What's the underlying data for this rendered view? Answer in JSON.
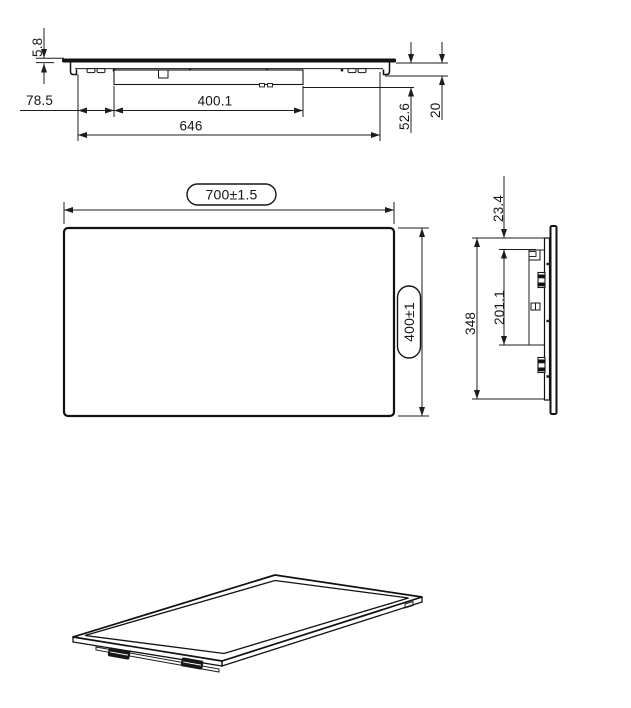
{
  "page": {
    "background": "#ffffff",
    "line_color": "#161616",
    "description": "Three-view dimensioned technical drawing of a flat panel with mounting rail, plus isometric view"
  },
  "views": {
    "top": {
      "dim_thickness": "5.8",
      "dim_bracket_offset": "78.5",
      "dim_rail_width": "400.1",
      "dim_mount_width": "646",
      "dim_total_depth": "52.6",
      "dim_edge_depth": "20"
    },
    "front": {
      "dim_width": "700±1.5",
      "dim_height": "400±1"
    },
    "side": {
      "dim_top_gap": "23.4",
      "dim_rail_height": "201.1",
      "dim_bracket_height": "348"
    }
  }
}
